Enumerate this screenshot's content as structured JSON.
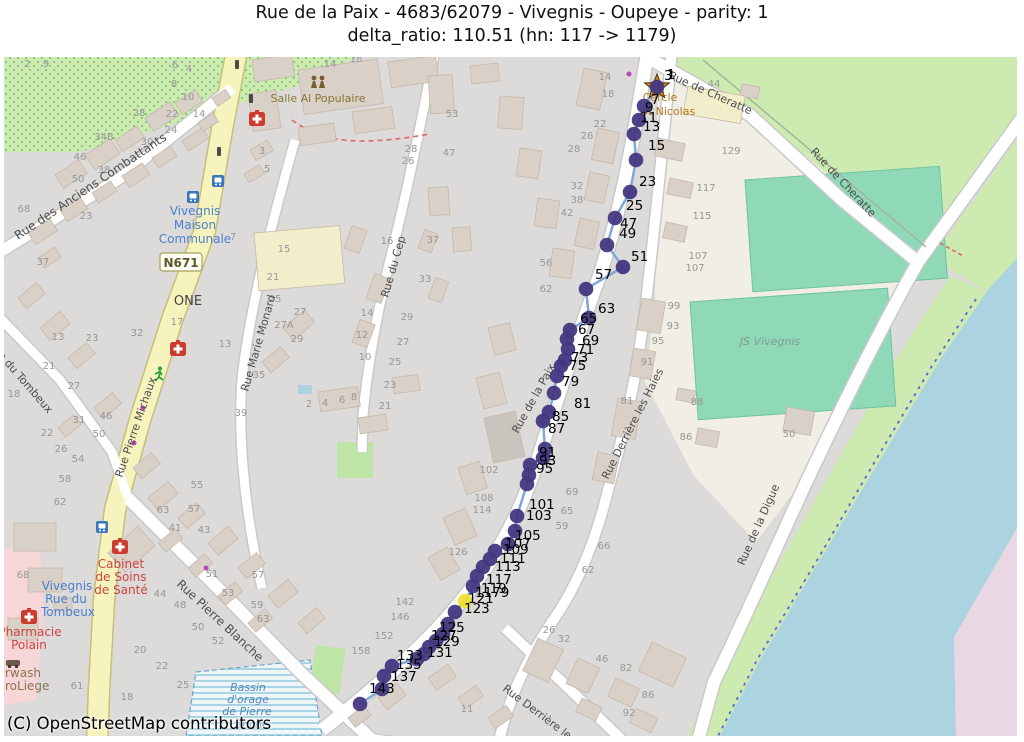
{
  "title": {
    "line1": "Rue de la Paix - 4683/62079 - Vivegnis - Oupeye - parity: 1",
    "line2": "delta_ratio: 110.51 (hn: 117 -> 1179)"
  },
  "attribution": "(C) OpenStreetMap contributors",
  "road_shield": {
    "t": "N671",
    "x": 181,
    "y": 267
  },
  "colors": {
    "map_bg": "#dcdbd9",
    "building": "#d9d0c8",
    "building_edge": "#c7b9a9",
    "road_fill": "#ffffff",
    "road_casing": "#c9c9c9",
    "yellow_road": "#f7f3bd",
    "yellow_casing": "#c6bf7a",
    "green": "#cdebb0",
    "pitch": "#8fd8b8",
    "water": "#abd4e0",
    "industrial_pink": "#e9d8e4",
    "retail_pink": "#f6d6d6",
    "route_line": "#7fa8d8",
    "route_dot": "#453781",
    "route_highlight": "#efe030",
    "house_number": "#979797",
    "street_label": "#4d4d4d"
  },
  "route": {
    "highlight_index": 33,
    "points": [
      [
        657,
        87
      ],
      [
        644,
        106
      ],
      [
        639,
        120
      ],
      [
        634,
        134
      ],
      [
        636,
        160
      ],
      [
        630,
        192
      ],
      [
        615,
        218
      ],
      [
        607,
        245
      ],
      [
        623,
        267
      ],
      [
        586,
        289
      ],
      [
        589,
        318
      ],
      [
        570,
        330
      ],
      [
        567,
        339
      ],
      [
        568,
        349
      ],
      [
        565,
        360
      ],
      [
        561,
        366
      ],
      [
        557,
        376
      ],
      [
        554,
        393
      ],
      [
        549,
        412
      ],
      [
        543,
        421
      ],
      [
        545,
        449
      ],
      [
        543,
        458
      ],
      [
        530,
        465
      ],
      [
        529,
        475
      ],
      [
        527,
        484
      ],
      [
        517,
        516
      ],
      [
        515,
        531
      ],
      [
        508,
        544
      ],
      [
        495,
        551
      ],
      [
        490,
        559
      ],
      [
        483,
        567
      ],
      [
        477,
        576
      ],
      [
        473,
        586
      ],
      [
        465,
        601
      ],
      [
        455,
        612
      ],
      [
        448,
        624
      ],
      [
        443,
        634
      ],
      [
        436,
        641
      ],
      [
        429,
        647
      ],
      [
        424,
        654
      ],
      [
        417,
        659
      ],
      [
        392,
        666
      ],
      [
        384,
        676
      ],
      [
        382,
        689
      ],
      [
        360,
        704
      ]
    ],
    "labels": [
      {
        "t": "3",
        "x": 664,
        "y": 80
      },
      {
        "t": "1",
        "x": 667,
        "y": 79
      },
      {
        "t": "7",
        "x": 651,
        "y": 104
      },
      {
        "t": "9",
        "x": 645,
        "y": 112
      },
      {
        "t": "11",
        "x": 640,
        "y": 122
      },
      {
        "t": "13",
        "x": 643,
        "y": 131
      },
      {
        "t": "15",
        "x": 648,
        "y": 150
      },
      {
        "t": "23",
        "x": 639,
        "y": 186
      },
      {
        "t": "25",
        "x": 626,
        "y": 210
      },
      {
        "t": "47",
        "x": 620,
        "y": 228
      },
      {
        "t": "49",
        "x": 619,
        "y": 238
      },
      {
        "t": "51",
        "x": 631,
        "y": 261
      },
      {
        "t": "57",
        "x": 595,
        "y": 279
      },
      {
        "t": "63",
        "x": 598,
        "y": 313
      },
      {
        "t": "65",
        "x": 580,
        "y": 323
      },
      {
        "t": "67",
        "x": 578,
        "y": 334
      },
      {
        "t": "69",
        "x": 582,
        "y": 345
      },
      {
        "t": "71",
        "x": 577,
        "y": 354
      },
      {
        "t": "73",
        "x": 571,
        "y": 362
      },
      {
        "t": "75",
        "x": 569,
        "y": 370
      },
      {
        "t": "79",
        "x": 562,
        "y": 386
      },
      {
        "t": "81",
        "x": 574,
        "y": 408
      },
      {
        "t": "85",
        "x": 552,
        "y": 421
      },
      {
        "t": "87",
        "x": 548,
        "y": 433
      },
      {
        "t": "91",
        "x": 539,
        "y": 457
      },
      {
        "t": "93",
        "x": 539,
        "y": 465
      },
      {
        "t": "95",
        "x": 536,
        "y": 473
      },
      {
        "t": "101",
        "x": 529,
        "y": 509
      },
      {
        "t": "103",
        "x": 526,
        "y": 520
      },
      {
        "t": "105",
        "x": 515,
        "y": 540
      },
      {
        "t": "107",
        "x": 505,
        "y": 548
      },
      {
        "t": "109",
        "x": 503,
        "y": 554
      },
      {
        "t": "111",
        "x": 500,
        "y": 563
      },
      {
        "t": "113",
        "x": 495,
        "y": 571
      },
      {
        "t": "117",
        "x": 486,
        "y": 584
      },
      {
        "t": "119",
        "x": 481,
        "y": 593
      },
      {
        "t": "1179",
        "x": 475,
        "y": 597
      },
      {
        "t": "121",
        "x": 468,
        "y": 603
      },
      {
        "t": "123",
        "x": 464,
        "y": 613
      },
      {
        "t": "125",
        "x": 439,
        "y": 632
      },
      {
        "t": "127",
        "x": 431,
        "y": 640
      },
      {
        "t": "129",
        "x": 434,
        "y": 646
      },
      {
        "t": "131",
        "x": 427,
        "y": 657
      },
      {
        "t": "133",
        "x": 397,
        "y": 660
      },
      {
        "t": "135",
        "x": 396,
        "y": 669
      },
      {
        "t": "137",
        "x": 391,
        "y": 681
      },
      {
        "t": "143",
        "x": 369,
        "y": 693
      }
    ]
  },
  "streets": [
    {
      "t": "Rue des Anciens Combattants",
      "x": 18,
      "y": 240,
      "r": -34,
      "s": 12
    },
    {
      "t": "Rue de Cheratte",
      "x": 668,
      "y": 78,
      "r": 24,
      "s": 11
    },
    {
      "t": "Rue de Cheratte",
      "x": 810,
      "y": 152,
      "r": 47,
      "s": 11
    },
    {
      "t": "Rue Marie Monard",
      "x": 248,
      "y": 392,
      "r": -74,
      "s": 11
    },
    {
      "t": "Rue du Cep",
      "x": 388,
      "y": 298,
      "r": -74,
      "s": 11
    },
    {
      "t": "Rue Pierre Michaux",
      "x": 122,
      "y": 478,
      "r": -71,
      "s": 11
    },
    {
      "t": "Rue du Tombeux",
      "x": -12,
      "y": 345,
      "r": 49,
      "s": 11
    },
    {
      "t": "Rue Pierre Blanche",
      "x": 176,
      "y": 585,
      "r": 43,
      "s": 12
    },
    {
      "t": "Rue Derrière les Haies",
      "x": 608,
      "y": 480,
      "r": -63,
      "s": 11
    },
    {
      "t": "Rue Derrière les",
      "x": 502,
      "y": 690,
      "r": 37,
      "s": 11
    },
    {
      "t": "Rue de la Digue",
      "x": 744,
      "y": 566,
      "r": -66,
      "s": 11
    },
    {
      "t": "Rue de la Paix",
      "x": 518,
      "y": 434,
      "r": -61,
      "s": 11
    }
  ],
  "pois": [
    {
      "t": "Salle Al Populaire",
      "x": 318,
      "y": 102,
      "c": "#8a7433",
      "s": 11,
      "a": "middle"
    },
    {
      "t": "Cercle",
      "x": 660,
      "y": 101,
      "c": "#b07820",
      "s": 11,
      "a": "middle"
    },
    {
      "t": "St Nicolas",
      "x": 668,
      "y": 115,
      "c": "#b07820",
      "s": 11,
      "a": "middle"
    },
    {
      "t": "Vivegnis",
      "x": 195,
      "y": 215,
      "c": "#4a7fd1",
      "s": 12,
      "a": "middle"
    },
    {
      "t": "Maison",
      "x": 195,
      "y": 229,
      "c": "#4a7fd1",
      "s": 12,
      "a": "middle"
    },
    {
      "t": "Communale",
      "x": 195,
      "y": 243,
      "c": "#4a7fd1",
      "s": 12,
      "a": "middle"
    },
    {
      "t": "Vivegnis",
      "x": 67,
      "y": 590,
      "c": "#4a7fd1",
      "s": 12,
      "a": "middle"
    },
    {
      "t": "Rue du",
      "x": 66,
      "y": 603,
      "c": "#4a7fd1",
      "s": 12,
      "a": "middle"
    },
    {
      "t": "Tombeux",
      "x": 68,
      "y": 616,
      "c": "#4a7fd1",
      "s": 12,
      "a": "middle"
    },
    {
      "t": "Cabinet",
      "x": 121,
      "y": 568,
      "c": "#cc4444",
      "s": 12,
      "a": "middle"
    },
    {
      "t": "de Soins",
      "x": 121,
      "y": 581,
      "c": "#cc4444",
      "s": 12,
      "a": "middle"
    },
    {
      "t": "de Santé",
      "x": 121,
      "y": 594,
      "c": "#cc4444",
      "s": 12,
      "a": "middle"
    },
    {
      "t": "Pharmacie",
      "x": 30,
      "y": 636,
      "c": "#cc4444",
      "s": 12,
      "a": "middle"
    },
    {
      "t": "Polain",
      "x": 29,
      "y": 649,
      "c": "#cc4444",
      "s": 12,
      "a": "middle"
    },
    {
      "t": "rwash",
      "x": 5,
      "y": 677,
      "c": "#8a7456",
      "s": 12,
      "a": "start"
    },
    {
      "t": "roLiege",
      "x": 5,
      "y": 690,
      "c": "#8a7456",
      "s": 12,
      "a": "start"
    },
    {
      "t": "Bassin",
      "x": 248,
      "y": 691,
      "c": "#5588bb",
      "s": 11,
      "a": "middle",
      "i": 1
    },
    {
      "t": "d'orage",
      "x": 248,
      "y": 703,
      "c": "#5588bb",
      "s": 11,
      "a": "middle",
      "i": 1
    },
    {
      "t": "de Pierre",
      "x": 247,
      "y": 715,
      "c": "#5588bb",
      "s": 11,
      "a": "middle",
      "i": 1
    },
    {
      "t": "anche",
      "x": 252,
      "y": 728,
      "c": "#5588bb",
      "s": 11,
      "a": "middle",
      "i": 1
    },
    {
      "t": "JS Vivegnis",
      "x": 770,
      "y": 345,
      "c": "#7d9e90",
      "s": 11,
      "a": "middle",
      "i": 1
    },
    {
      "t": "ONE",
      "x": 188,
      "y": 305,
      "c": "#444444",
      "s": 13,
      "a": "middle"
    }
  ],
  "house_numbers": [
    [
      "28",
      139,
      116
    ],
    [
      "22",
      172,
      117
    ],
    [
      "14",
      199,
      117
    ],
    [
      "24",
      171,
      133
    ],
    [
      "30",
      147,
      145
    ],
    [
      "34B",
      104,
      140
    ],
    [
      "46",
      80,
      160
    ],
    [
      "38",
      104,
      173
    ],
    [
      "50",
      78,
      182
    ],
    [
      "23",
      86,
      219
    ],
    [
      "68",
      24,
      212
    ],
    [
      "37",
      43,
      265
    ],
    [
      "6",
      175,
      68
    ],
    [
      "4",
      189,
      72
    ],
    [
      "8",
      174,
      87
    ],
    [
      "10",
      188,
      100
    ],
    [
      "2",
      27,
      67
    ],
    [
      "9",
      46,
      67
    ],
    [
      "18",
      356,
      62
    ],
    [
      "14",
      330,
      67
    ],
    [
      "3",
      262,
      154
    ],
    [
      "5",
      267,
      172
    ],
    [
      "53",
      452,
      117
    ],
    [
      "47",
      449,
      156
    ],
    [
      "28",
      411,
      152
    ],
    [
      "26",
      408,
      164
    ],
    [
      "13",
      58,
      340
    ],
    [
      "23",
      92,
      341
    ],
    [
      "21",
      49,
      369
    ],
    [
      "27",
      74,
      389
    ],
    [
      "18",
      14,
      397
    ],
    [
      "31",
      79,
      423
    ],
    [
      "46",
      106,
      419
    ],
    [
      "50",
      99,
      437
    ],
    [
      "22",
      47,
      436
    ],
    [
      "26",
      61,
      452
    ],
    [
      "54",
      78,
      462
    ],
    [
      "58",
      65,
      482
    ],
    [
      "62",
      60,
      505
    ],
    [
      "68",
      23,
      578
    ],
    [
      "55",
      197,
      488
    ],
    [
      "57",
      194,
      512
    ],
    [
      "63",
      163,
      513
    ],
    [
      "41",
      175,
      531
    ],
    [
      "43",
      204,
      533
    ],
    [
      "51",
      212,
      577
    ],
    [
      "53",
      228,
      596
    ],
    [
      "57",
      258,
      578
    ],
    [
      "59",
      257,
      608
    ],
    [
      "63",
      263,
      622
    ],
    [
      "44",
      160,
      597
    ],
    [
      "48",
      180,
      608
    ],
    [
      "50",
      198,
      630
    ],
    [
      "52",
      218,
      644
    ],
    [
      "20",
      140,
      653
    ],
    [
      "22",
      162,
      669
    ],
    [
      "25",
      183,
      688
    ],
    [
      "18",
      127,
      700
    ],
    [
      "61",
      77,
      689
    ],
    [
      "7",
      233,
      240
    ],
    [
      "15",
      284,
      252
    ],
    [
      "21",
      273,
      280
    ],
    [
      "25",
      275,
      302
    ],
    [
      "27",
      300,
      315
    ],
    [
      "27A",
      284,
      328
    ],
    [
      "29",
      297,
      342
    ],
    [
      "35",
      259,
      378
    ],
    [
      "39",
      241,
      416
    ],
    [
      "13",
      225,
      347
    ],
    [
      "17",
      177,
      325
    ],
    [
      "32",
      137,
      336
    ],
    [
      "2",
      309,
      407
    ],
    [
      "4",
      325,
      406
    ],
    [
      "6",
      342,
      403
    ],
    [
      "8",
      354,
      400
    ],
    [
      "16",
      387,
      244
    ],
    [
      "37",
      433,
      243
    ],
    [
      "33",
      425,
      282
    ],
    [
      "29",
      407,
      320
    ],
    [
      "27",
      403,
      345
    ],
    [
      "25",
      395,
      365
    ],
    [
      "23",
      390,
      388
    ],
    [
      "21",
      385,
      409
    ],
    [
      "14",
      367,
      316
    ],
    [
      "12",
      362,
      338
    ],
    [
      "10",
      365,
      360
    ],
    [
      "14",
      605,
      80
    ],
    [
      "18",
      608,
      97
    ],
    [
      "22",
      600,
      127
    ],
    [
      "26",
      587,
      139
    ],
    [
      "28",
      574,
      152
    ],
    [
      "32",
      577,
      189
    ],
    [
      "38",
      577,
      203
    ],
    [
      "42",
      567,
      216
    ],
    [
      "44",
      714,
      87
    ],
    [
      "129",
      731,
      154
    ],
    [
      "117",
      706,
      191
    ],
    [
      "115",
      702,
      219
    ],
    [
      "107",
      698,
      259
    ],
    [
      "107",
      695,
      271
    ],
    [
      "56",
      546,
      266
    ],
    [
      "62",
      546,
      292
    ],
    [
      "99",
      674,
      309
    ],
    [
      "93",
      673,
      329
    ],
    [
      "95",
      658,
      344
    ],
    [
      "91",
      647,
      365
    ],
    [
      "81",
      627,
      404
    ],
    [
      "88",
      697,
      405
    ],
    [
      "86",
      686,
      440
    ],
    [
      "50",
      789,
      437
    ],
    [
      "102",
      489,
      473
    ],
    [
      "108",
      484,
      501
    ],
    [
      "114",
      482,
      513
    ],
    [
      "126",
      458,
      555
    ],
    [
      "69",
      572,
      495
    ],
    [
      "65",
      567,
      514
    ],
    [
      "59",
      562,
      529
    ],
    [
      "66",
      604,
      549
    ],
    [
      "62",
      588,
      573
    ],
    [
      "26",
      549,
      633
    ],
    [
      "32",
      564,
      642
    ],
    [
      "46",
      602,
      662
    ],
    [
      "82",
      626,
      671
    ],
    [
      "86",
      648,
      698
    ],
    [
      "92",
      629,
      716
    ],
    [
      "11",
      467,
      712
    ],
    [
      "142",
      405,
      605
    ],
    [
      "146",
      400,
      620
    ],
    [
      "152",
      384,
      639
    ],
    [
      "158",
      361,
      654
    ]
  ]
}
